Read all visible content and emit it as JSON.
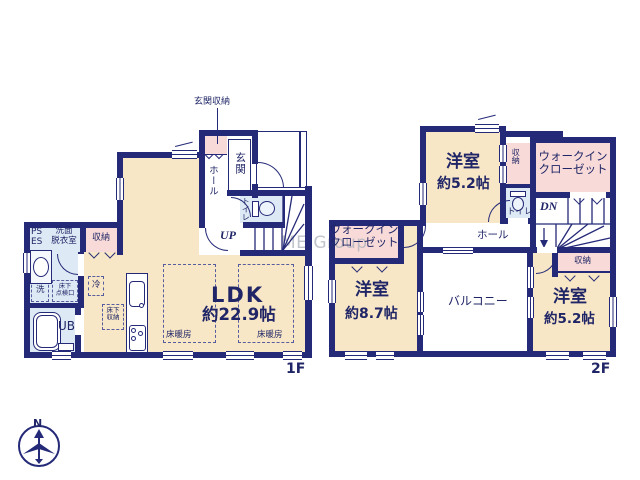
{
  "watermark": "ME Group",
  "compass_label": "N",
  "colors": {
    "wall": "#252a78",
    "room_cream": "#f8e7c6",
    "closet_pink": "#f8dbd8",
    "wet_blue": "#dde9f4",
    "text_navy": "#1f2566",
    "watermark_gray": "#a9aeb9"
  },
  "floor1": {
    "label": "1F",
    "entrance_storage_label": "玄関収納",
    "entrance": "玄関",
    "hall": "ホール",
    "toilet": "トイレ",
    "stairs": "UP",
    "ldk_name": "LDK",
    "ldk_size": "約22.9帖",
    "floor_heating_left": "床暖房",
    "floor_heating_right": "床暖房",
    "closet": "収納",
    "ps": "PS",
    "es": "ES",
    "washroom_l1": "洗面",
    "washroom_l2": "脱衣室",
    "washer": "洗",
    "underfloor_hatch_l1": "床下",
    "underfloor_hatch_l2": "点検口",
    "fridge": "冷",
    "unit_bath": "UB",
    "underfloor_storage_l1": "床下",
    "underfloor_storage_l2": "収納"
  },
  "floor2": {
    "label": "2F",
    "bedroom_top_name": "洋室",
    "bedroom_top_size": "約5.2帖",
    "closet_top": "収納",
    "wic_right_l1": "ウォークイン",
    "wic_right_l2": "クローゼット",
    "toilet": "トイレ",
    "stairs": "DN",
    "hall": "ホール",
    "wic_left_l1": "ウォークイン",
    "wic_left_l2": "クローゼット",
    "bedroom_left_name": "洋室",
    "bedroom_left_size": "約8.7帖",
    "balcony": "バルコニー",
    "closet_bottom": "収納",
    "bedroom_right_name": "洋室",
    "bedroom_right_size": "約5.2帖"
  }
}
